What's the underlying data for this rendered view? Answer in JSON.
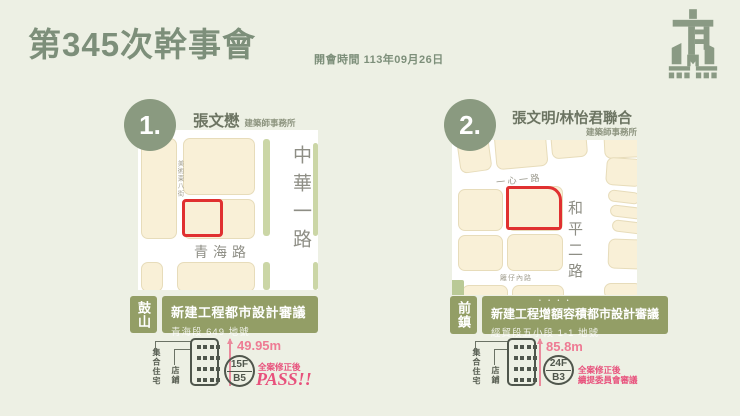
{
  "header": {
    "title": "第345次幹事會",
    "meeting_label": "開會時間",
    "meeting_date": "113年09月26日"
  },
  "colors": {
    "sage": "#7d8f7a",
    "olive_box": "#939e66",
    "map_block": "#f9f0d7",
    "site_outline_red": "#e03030",
    "accent_pink": "#e8517c"
  },
  "cases": [
    {
      "number": "1.",
      "architect": "張文懋",
      "architect_suffix": "建築師事務所",
      "district": "鼓山",
      "review_title": "新建工程都市設計審議",
      "lot": "青海段 649 地號",
      "map": {
        "road_main": "中華一路",
        "road_cross": "青海路",
        "road_minor": "美術東八街"
      },
      "building": {
        "use_primary": "集合住宅",
        "use_secondary": "店鋪",
        "height": "49.95m",
        "floors_above": "15F",
        "floors_below": "B5",
        "result_note": "全案修正後",
        "result": "PASS!!"
      }
    },
    {
      "number": "2.",
      "architect": "張文明/林怡君聯合",
      "architect_suffix": "建築師事務所",
      "district": "前鎮",
      "review_title": "新建工程增額容積都市設計審議",
      "review_emphasis": "••••",
      "lot": "經貿段五小段 1-1 地號",
      "map": {
        "road_main": "和平二路",
        "road_cross": "一心一路",
        "road_minor": "籬仔內路"
      },
      "building": {
        "use_primary": "集合住宅",
        "use_secondary": "店鋪",
        "height": "85.8m",
        "floors_above": "24F",
        "floors_below": "B3",
        "result_note": "全案修正後",
        "result": "續提委員會審議"
      }
    }
  ]
}
